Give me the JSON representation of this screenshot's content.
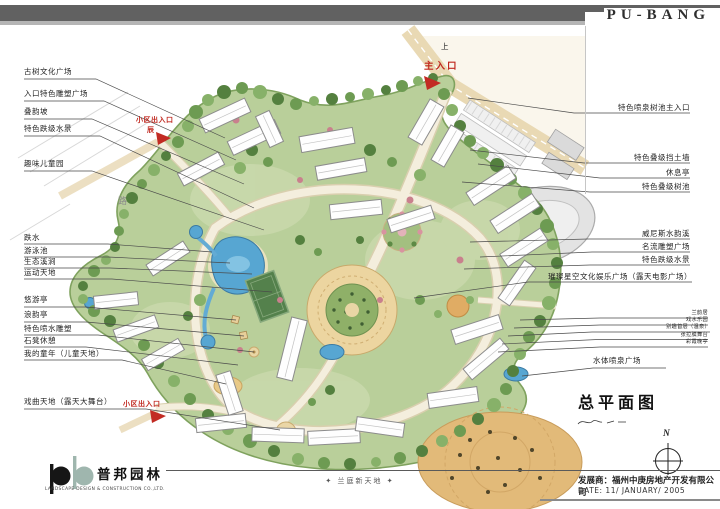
{
  "header": {
    "brand": "PU-BANG"
  },
  "plan": {
    "direction_up": "上",
    "main_entrance": "主入口",
    "road": "路",
    "side_entrance": "小区出入口",
    "side_entrance_mark": "辰",
    "bottom_entrance": "小区出入口",
    "left_labels": [
      "古树文化广场",
      "入口特色雕塑广场",
      "叠韵坡",
      "特色跌级水景",
      "趣味儿童园",
      "跌水",
      "游泳池",
      "生态溪涧",
      "运动天地",
      "悠游亭",
      "浪韵亭",
      "特色喷水雕塑",
      "石凳休憩",
      "我的童年（儿童天地）",
      "戏曲天地（露天大舞台）"
    ],
    "right_labels": [
      "特色喷泉树池主入口",
      "特色叠级挡土墙",
      "休息亭",
      "特色叠级树池",
      "威尼斯水韵溪",
      "名流雕塑广场",
      "特色跌级水景",
      "璀璨星空文化娱乐广场（露天电影广场）",
      "兰韵居",
      "戏水乐园",
      "别趣首层（温泉）",
      "张拉膜舞台",
      "彩霞晚亭",
      "水体喷泉广场"
    ]
  },
  "footer": {
    "logo_cn": "普邦园林",
    "logo_en": "LANDSCAPE DESIGN & CONSTRUCTION CO.,LTD.",
    "project_name": "✦ 兰庭新天地 ✦",
    "drawing_title": "总平面图",
    "developer": "发展商：福州中庚房地产开发有限公司",
    "date": "DATE: 11/ JANUARY/ 2005",
    "compass": "N"
  },
  "colors": {
    "header_bar": "#616161",
    "accent_red": "#c0281f",
    "site_green": "#b9cf9a",
    "road_cream": "#f4eedd",
    "plaza_tan": "#e2ba79",
    "water_blue": "#57a6d2"
  }
}
